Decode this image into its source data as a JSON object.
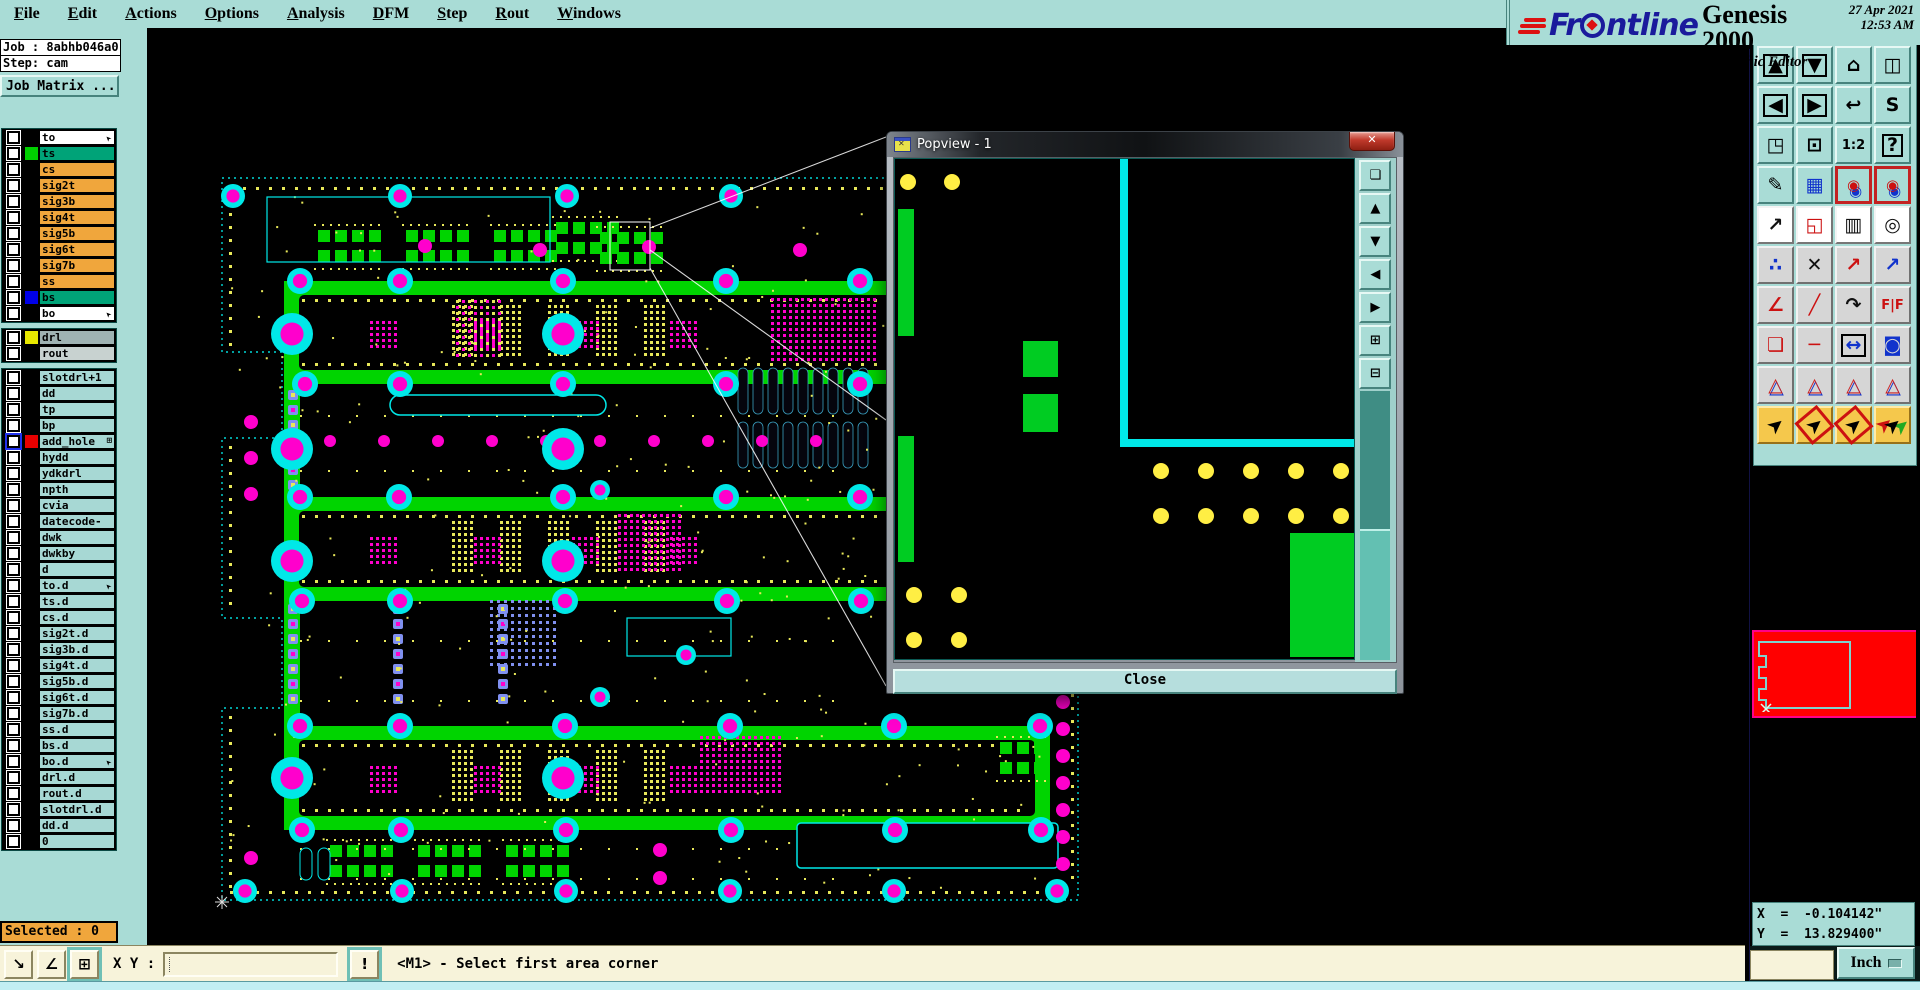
{
  "menubar": {
    "items": [
      {
        "label": "File"
      },
      {
        "label": "Edit"
      },
      {
        "label": "Actions"
      },
      {
        "label": "Options"
      },
      {
        "label": "Analysis"
      },
      {
        "label": "DFM"
      },
      {
        "label": "Step"
      },
      {
        "label": "Rout"
      },
      {
        "label": "Windows"
      }
    ],
    "help": "Help"
  },
  "brand": {
    "logo": "Frontline",
    "product": "Genesis 2000",
    "edition": "Graphic Editor",
    "date": "27 Apr 2021",
    "time": "12:53 AM"
  },
  "job_panel": {
    "job": "Job : 8abhb046a0",
    "step": "Step: cam",
    "matrix_button": "Job Matrix ..."
  },
  "layers": {
    "group1": [
      {
        "label": "to",
        "bg": "white",
        "marker": "arrow"
      },
      {
        "label": "ts",
        "bg": "green",
        "swatch": "#00d000"
      },
      {
        "label": "cs",
        "bg": "orange"
      },
      {
        "label": "sig2t",
        "bg": "orange"
      },
      {
        "label": "sig3b",
        "bg": "orange"
      },
      {
        "label": "sig4t",
        "bg": "orange"
      },
      {
        "label": "sig5b",
        "bg": "orange"
      },
      {
        "label": "sig6t",
        "bg": "orange"
      },
      {
        "label": "sig7b",
        "bg": "orange"
      },
      {
        "label": "ss",
        "bg": "orange"
      },
      {
        "label": "bs",
        "bg": "green",
        "swatch": "#0000e8"
      },
      {
        "label": "bo",
        "bg": "white",
        "marker": "arrow"
      }
    ],
    "group2": [
      {
        "label": "drl",
        "bg": "gray",
        "swatch": "#e8e800"
      },
      {
        "label": "rout",
        "bg": "lightgray"
      }
    ],
    "group3": [
      {
        "label": "slotdrl+1",
        "bg": "cyan"
      },
      {
        "label": "dd",
        "bg": "cyan"
      },
      {
        "label": "tp",
        "bg": "cyan"
      },
      {
        "label": "bp",
        "bg": "cyan"
      },
      {
        "label": "add_hole",
        "bg": "cyan",
        "swatch": "#e80000",
        "selected": true,
        "marker": "grid"
      },
      {
        "label": "hydd",
        "bg": "cyan"
      },
      {
        "label": "ydkdrl",
        "bg": "cyan"
      },
      {
        "label": "npth",
        "bg": "cyan"
      },
      {
        "label": "cvia",
        "bg": "cyan"
      },
      {
        "label": "datecode-to",
        "bg": "cyan"
      },
      {
        "label": "dwk",
        "bg": "cyan"
      },
      {
        "label": "dwkby",
        "bg": "cyan"
      },
      {
        "label": "d",
        "bg": "cyan"
      },
      {
        "label": "to.d",
        "bg": "cyan",
        "marker": "arrow"
      },
      {
        "label": "ts.d",
        "bg": "cyan"
      },
      {
        "label": "cs.d",
        "bg": "cyan"
      },
      {
        "label": "sig2t.d",
        "bg": "cyan"
      },
      {
        "label": "sig3b.d",
        "bg": "cyan"
      },
      {
        "label": "sig4t.d",
        "bg": "cyan"
      },
      {
        "label": "sig5b.d",
        "bg": "cyan"
      },
      {
        "label": "sig6t.d",
        "bg": "cyan"
      },
      {
        "label": "sig7b.d",
        "bg": "cyan"
      },
      {
        "label": "ss.d",
        "bg": "cyan"
      },
      {
        "label": "bs.d",
        "bg": "cyan"
      },
      {
        "label": "bo.d",
        "bg": "cyan",
        "marker": "arrow"
      },
      {
        "label": "drl.d",
        "bg": "cyan"
      },
      {
        "label": "rout.d",
        "bg": "cyan"
      },
      {
        "label": "slotdrl.d",
        "bg": "cyan"
      },
      {
        "label": "dd.d",
        "bg": "cyan"
      },
      {
        "label": "0",
        "bg": "cyan"
      }
    ]
  },
  "popview": {
    "title": "Popview - 1",
    "close_button": "Close",
    "tools": [
      {
        "name": "pop-detach-button",
        "glyph": "❏"
      },
      {
        "name": "pop-pan-up-button",
        "glyph": "▲"
      },
      {
        "name": "pop-pan-down-button",
        "glyph": "▼"
      },
      {
        "name": "pop-pan-left-button",
        "glyph": "◀"
      },
      {
        "name": "pop-pan-right-button",
        "glyph": "▶"
      },
      {
        "name": "pop-zoom-in-button",
        "glyph": "⊞"
      },
      {
        "name": "pop-zoom-out-button",
        "glyph": "⊟"
      }
    ]
  },
  "toolbar": {
    "rows": [
      [
        {
          "name": "pan-up-button",
          "glyph": "▲",
          "style": "box"
        },
        {
          "name": "pan-down-button",
          "glyph": "▼",
          "style": "box"
        },
        {
          "name": "home-view-button",
          "glyph": "⌂",
          "style": ""
        },
        {
          "name": "window-xy-button",
          "glyph": "◫",
          "style": ""
        }
      ],
      [
        {
          "name": "pan-left-button",
          "glyph": "◀",
          "style": "box"
        },
        {
          "name": "pan-right-button",
          "glyph": "▶",
          "style": "box"
        },
        {
          "name": "previous-view-button",
          "glyph": "↩",
          "style": ""
        },
        {
          "name": "serpentine-view-button",
          "glyph": "S",
          "style": ""
        }
      ],
      [
        {
          "name": "zoom-out-button",
          "glyph": "◳",
          "style": ""
        },
        {
          "name": "zoom-in-button",
          "glyph": "⊡",
          "style": ""
        },
        {
          "name": "scale-1-2-button",
          "glyph": "1:2",
          "style": "text"
        },
        {
          "name": "query-button",
          "glyph": "?",
          "style": "box"
        }
      ],
      [
        {
          "name": "setup-tools-button",
          "glyph": "✎",
          "style": ""
        },
        {
          "name": "grid-button",
          "glyph": "▦",
          "style": "blue"
        },
        {
          "name": "netlist-top-button",
          "glyph": "◉",
          "style": "reddot",
          "btn": "active-red"
        },
        {
          "name": "netlist-bottom-button",
          "glyph": "◉",
          "style": "reddot",
          "btn": "active-red"
        }
      ],
      [
        {
          "name": "move-view-button",
          "glyph": "↗",
          "style": "dark",
          "btn": "white"
        },
        {
          "name": "zoom-window-button",
          "glyph": "◱",
          "style": "red",
          "btn": "white"
        },
        {
          "name": "ruler-button",
          "glyph": "▥",
          "style": "dark",
          "btn": "white"
        },
        {
          "name": "select-pad-button",
          "glyph": "◎",
          "style": "dark",
          "btn": "white"
        }
      ],
      [
        {
          "name": "net-points-button",
          "glyph": "∴",
          "style": "blue",
          "btn": "gray"
        },
        {
          "name": "cancel-button",
          "glyph": "✕",
          "style": "dark",
          "btn": "gray"
        },
        {
          "name": "copy-to-button",
          "glyph": "↗",
          "style": "red",
          "btn": "gray"
        },
        {
          "name": "move-to-button",
          "glyph": "↗",
          "style": "blue",
          "btn": "gray"
        }
      ],
      [
        {
          "name": "angle-measure-button",
          "glyph": "∠",
          "style": "red",
          "btn": "gray"
        },
        {
          "name": "line-measure-button",
          "glyph": "╱",
          "style": "red",
          "btn": "gray"
        },
        {
          "name": "rotate-button",
          "glyph": "↷",
          "style": "dark",
          "btn": "gray"
        },
        {
          "name": "mirror-button",
          "glyph": "F|F",
          "style": "text red",
          "btn": "gray"
        }
      ],
      [
        {
          "name": "copy-pad-button",
          "glyph": "❏",
          "style": "red",
          "btn": "gray"
        },
        {
          "name": "spacing-button",
          "glyph": "─",
          "style": "red",
          "btn": "gray"
        },
        {
          "name": "distance-button",
          "glyph": "↔",
          "style": "blue box",
          "btn": "gray"
        },
        {
          "name": "surface-button",
          "glyph": "◙",
          "style": "blue",
          "btn": "gray"
        }
      ],
      [
        {
          "name": "profile-triangle-1-button",
          "glyph": "△",
          "style": "tri",
          "btn": "gray"
        },
        {
          "name": "profile-triangle-2-button",
          "glyph": "△",
          "style": "tri",
          "btn": "gray"
        },
        {
          "name": "profile-triangle-3-button",
          "glyph": "△",
          "style": "tri",
          "btn": "gray"
        },
        {
          "name": "profile-triangle-4-button",
          "glyph": "△",
          "style": "tri",
          "btn": "gray"
        }
      ],
      [
        {
          "name": "select-cursor-button",
          "glyph": "➤",
          "style": "cursor",
          "btn": "yellow"
        },
        {
          "name": "select-frame-button",
          "glyph": "➤",
          "style": "cursor red-frame",
          "btn": "yellow"
        },
        {
          "name": "select-polygon-button",
          "glyph": "➤",
          "style": "cursor red-frame",
          "btn": "yellow"
        },
        {
          "name": "select-net-button",
          "glyph": "➤",
          "style": "cursor dots",
          "btn": "yellow"
        }
      ]
    ]
  },
  "coords": {
    "x": "X  =  -0.104142\"",
    "y": "Y  =  13.829400\""
  },
  "units": {
    "label": "Inch"
  },
  "command_bar": {
    "selected": "Selected : 0",
    "xy_label": "X Y :",
    "input_value": "",
    "prompt_button": "!",
    "status": "<M1> - Select first area corner",
    "icon_buttons": [
      {
        "name": "diagonal-measure-button",
        "glyph": "↘"
      },
      {
        "name": "angle-alpha-button",
        "glyph": "∠"
      },
      {
        "name": "window-grid-button",
        "glyph": "⊞",
        "active": true
      }
    ]
  },
  "colors": {
    "ui_teal": "#a9dcd6",
    "canvas_green": "#00d400",
    "via_cyan": "#00e8e8",
    "pad_magenta": "#ff00cc",
    "dot_yellow": "#e8e85a",
    "selected_orange": "#f0a63c",
    "navigator_red": "#ff0000"
  }
}
